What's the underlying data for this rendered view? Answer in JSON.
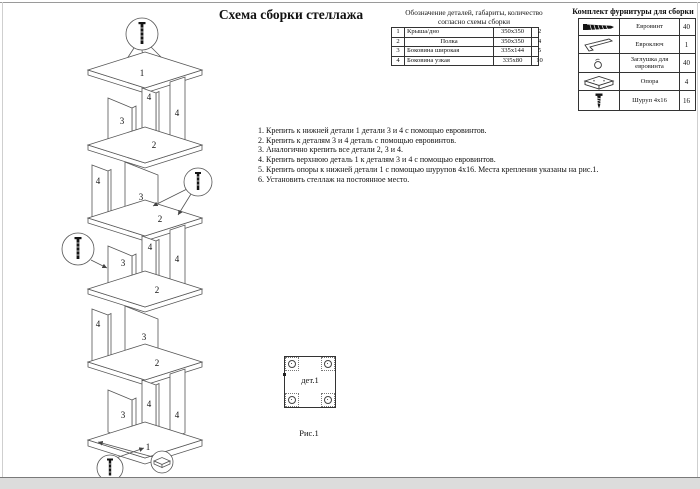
{
  "page": {
    "title": "Схема сборки стеллажа"
  },
  "colors": {
    "ink": "#111",
    "line": "#555",
    "frame": "#9a9a9a"
  },
  "parts_table": {
    "header_line1": "Обозначение деталей, габариты, количество",
    "header_line2": "согласно схемы сборки",
    "rows": [
      {
        "num": "1",
        "name": "Крыша/дно",
        "size": "350х350",
        "qty": "2"
      },
      {
        "num": "2",
        "name": "Полка",
        "size": "350х350",
        "qty": "4"
      },
      {
        "num": "3",
        "name": "Боковина широкая",
        "size": "335х144",
        "qty": "5"
      },
      {
        "num": "4",
        "name": "Боковина узкая",
        "size": "335х80",
        "qty": "10"
      }
    ]
  },
  "hardware_table": {
    "title": "Комплект фурнитуры для сборки",
    "rows": [
      {
        "icon": "euroscrew-icon",
        "name": "Евровинт",
        "qty": "40"
      },
      {
        "icon": "hexkey-icon",
        "name": "Евроключ",
        "qty": "1"
      },
      {
        "icon": "cap-icon",
        "name": "Заглушка для евровинта",
        "qty": "40"
      },
      {
        "icon": "foot-icon",
        "name": "Опора",
        "qty": "4"
      },
      {
        "icon": "screw-icon",
        "name": "Шуруп 4х16",
        "qty": "16"
      }
    ]
  },
  "instructions": [
    "1. Крепить к нижней детали 1 детали 3 и 4 с помощью евровинтов.",
    "2. Крепить к деталям 3 и 4 деталь с помощью евровинтов.",
    "3. Аналогично крепить все детали 2, 3 и 4.",
    "4. Крепить верхнюю деталь 1 к деталям 3 и 4 с помощью евровинтов.",
    "5. Крепить опоры к нижней детали 1 с помощью шурупов 4х16. Места крепления указаны на рис.1.",
    "6. Установить стеллаж на постоянное место."
  ],
  "figure": {
    "part_label": "дет.1",
    "caption": "Рис.1"
  },
  "shelf_diagram": {
    "labels": [
      "1",
      "3",
      "4",
      "4",
      "2",
      "4",
      "3",
      "2",
      "3",
      "4",
      "4",
      "2",
      "4",
      "3",
      "2",
      "3",
      "4",
      "4",
      "1"
    ]
  }
}
